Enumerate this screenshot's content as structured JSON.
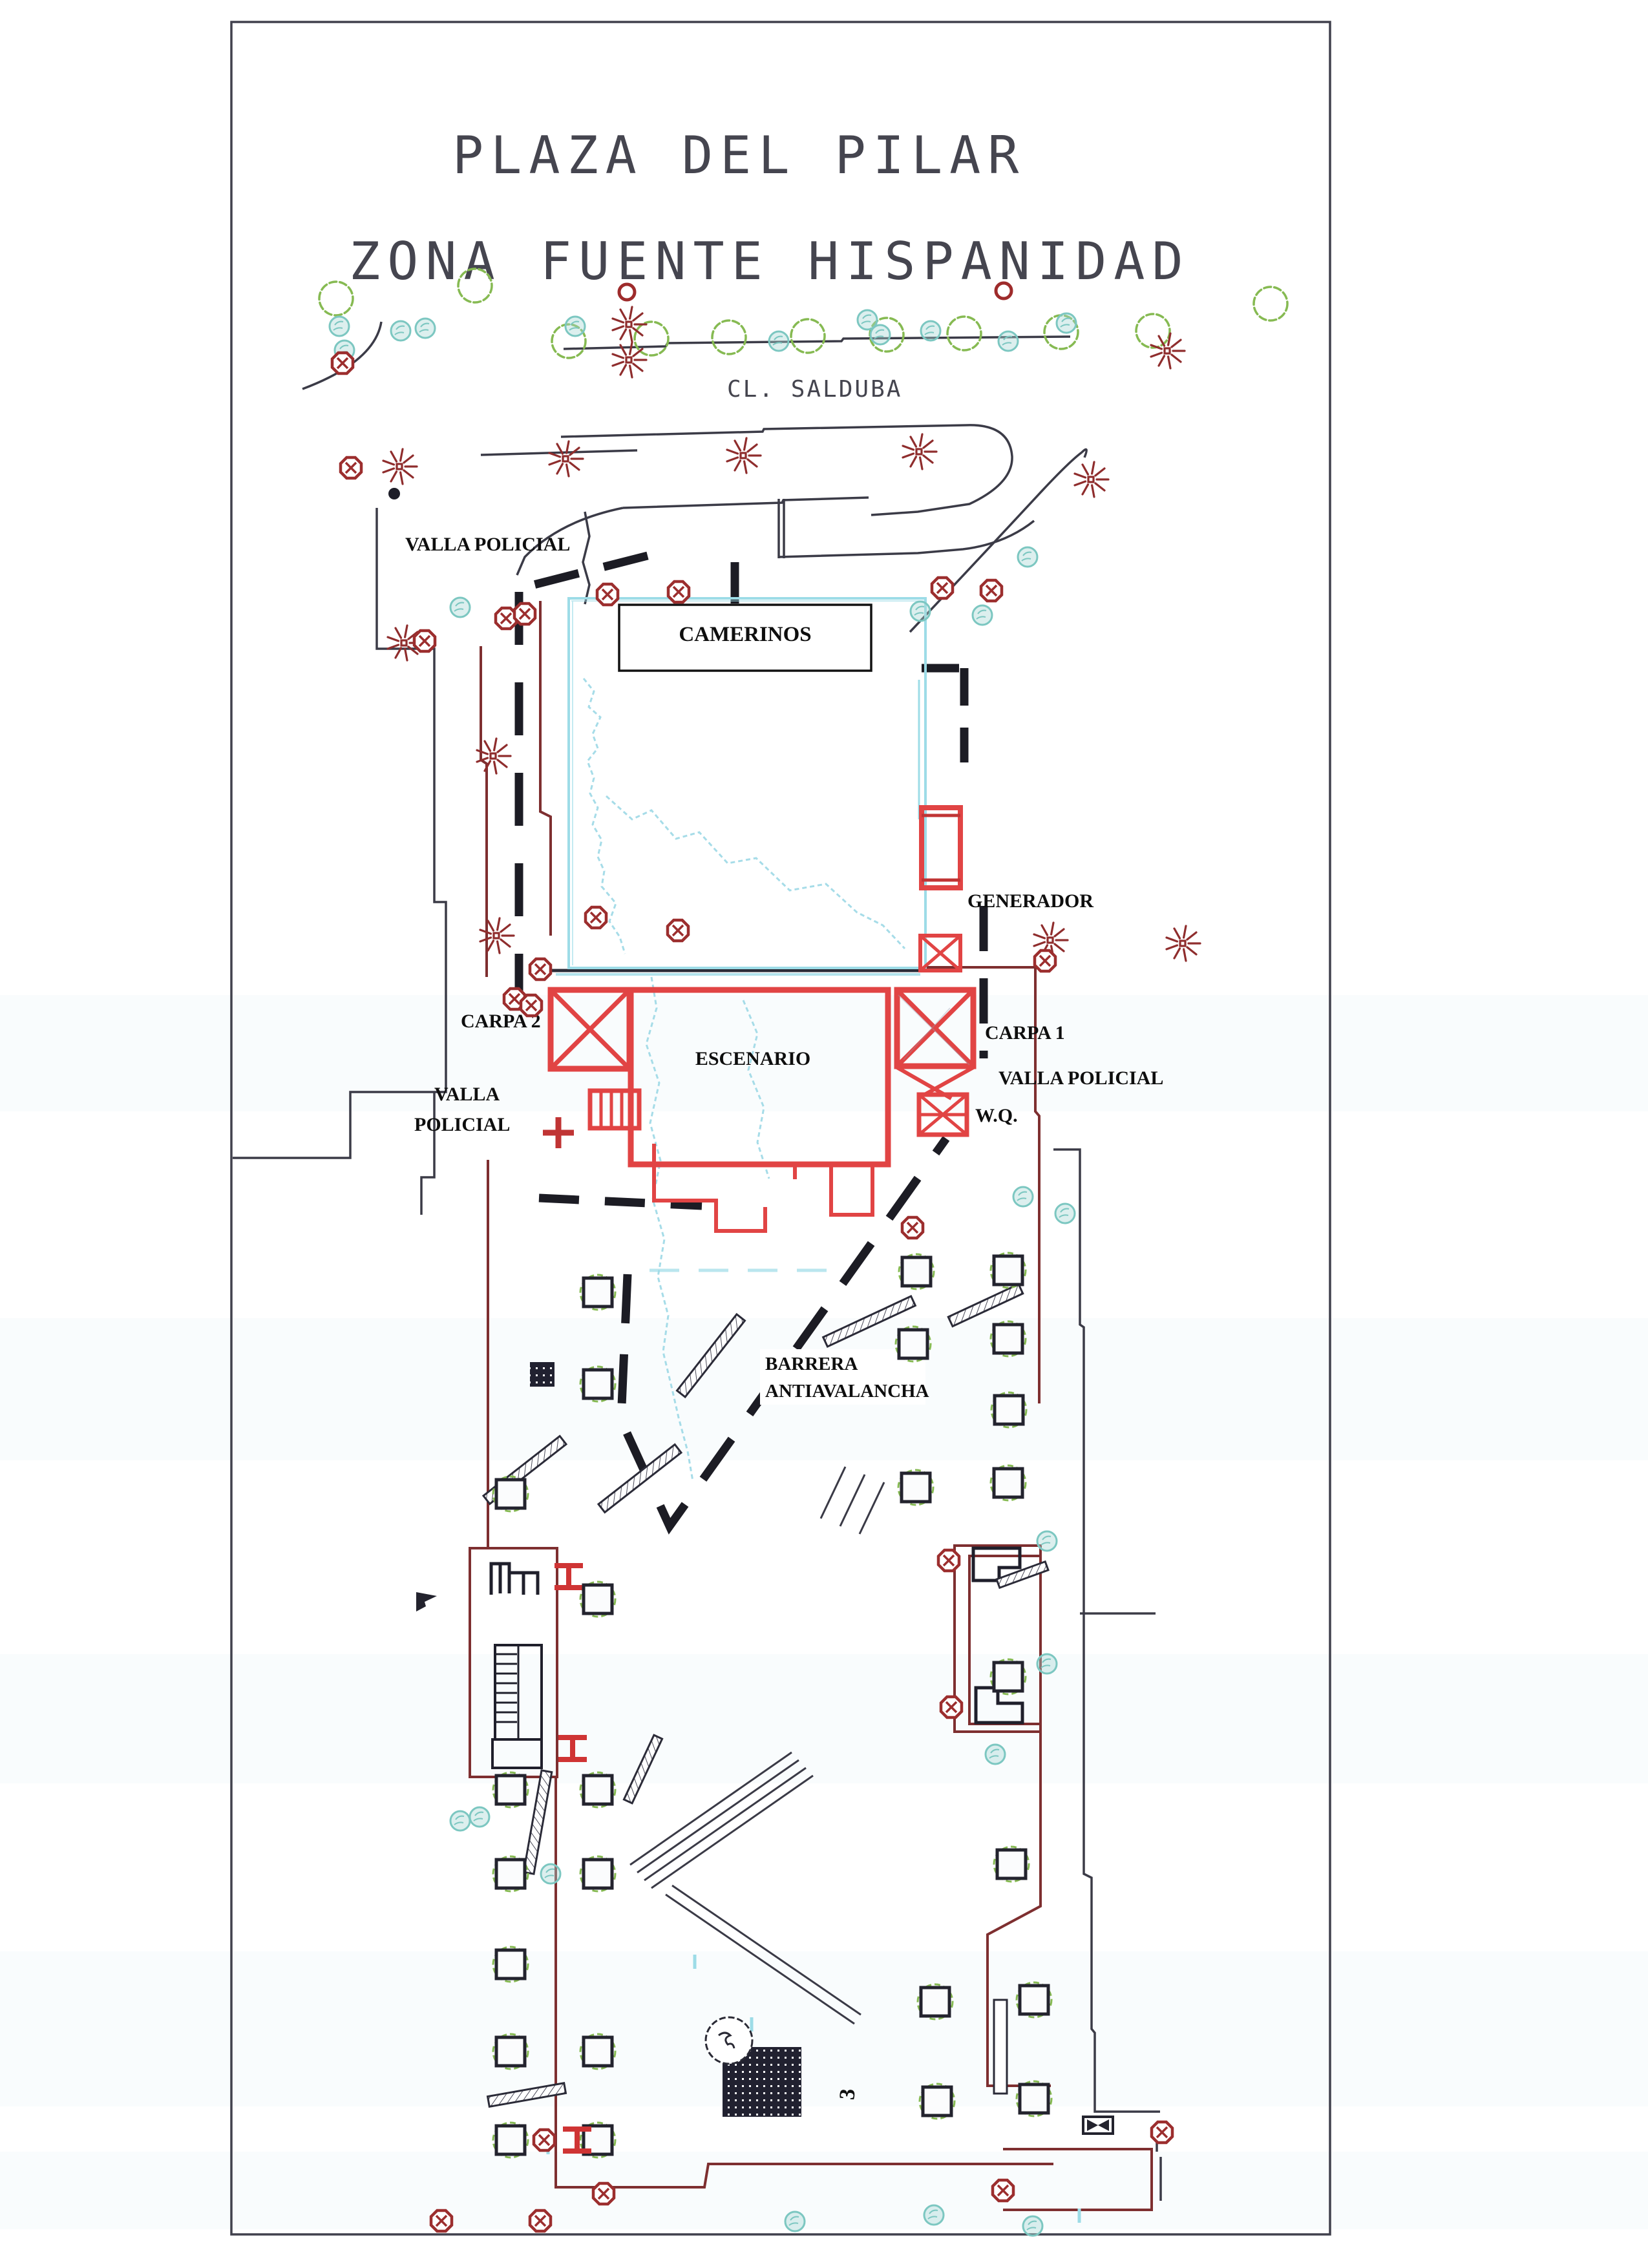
{
  "page": {
    "title_line1": "PLAZA DEL PILAR",
    "title_line2": "ZONA FUENTE HISPANIDAD",
    "street_label": "CL.  SALDUBA"
  },
  "labels": {
    "valla_policial_top": "VALLA POLICIAL",
    "camerinos": "CAMERINOS",
    "generador": "GENERADOR",
    "carpa_2": "CARPA 2",
    "carpa_1": "CARPA 1",
    "escenario": "ESCENARIO",
    "valla_left_line1": "VALLA",
    "valla_left_line2": "POLICIAL",
    "valla_policial_right": "VALLA POLICIAL",
    "wq": "W.Q.",
    "barrera_line1": "BARRERA",
    "barrera_line2": "ANTIAVALANCHA",
    "marker_3": "3"
  },
  "colors": {
    "stage_red": "#e14444",
    "symbol_dark_red": "#9c2e2e",
    "road_maroon": "#7e2f30",
    "line_dark": "#3b3b47",
    "barrier_dash_black": "#1c1c24",
    "fountain_cyan": "#9ddce7",
    "bush_teal": "#7cc7c1",
    "tree_green": "#86ba52",
    "label_black": "#0e0e0e",
    "title_gray": "#45454f",
    "paper_white": "#ffffff"
  },
  "symbols": {
    "streetlight_icon": "dark-red radial star burst",
    "utility_icon": "dark-red octagon with cross",
    "tree_planter_icon": "dark square with green shrub scribble",
    "street_tree_icon": "green scalloped cloud circle",
    "bush_icon": "light teal hatched circle",
    "police_barrier_icon": "thick black dashed line",
    "stage_icon": "red rectangle outline",
    "tent_icon": "red square with X cross",
    "hbeam_icon": "red I-beam profile mark",
    "valve_icon": "black bowtie in rectangle",
    "dark_paved_area_icon": "black square with white dot grid"
  }
}
